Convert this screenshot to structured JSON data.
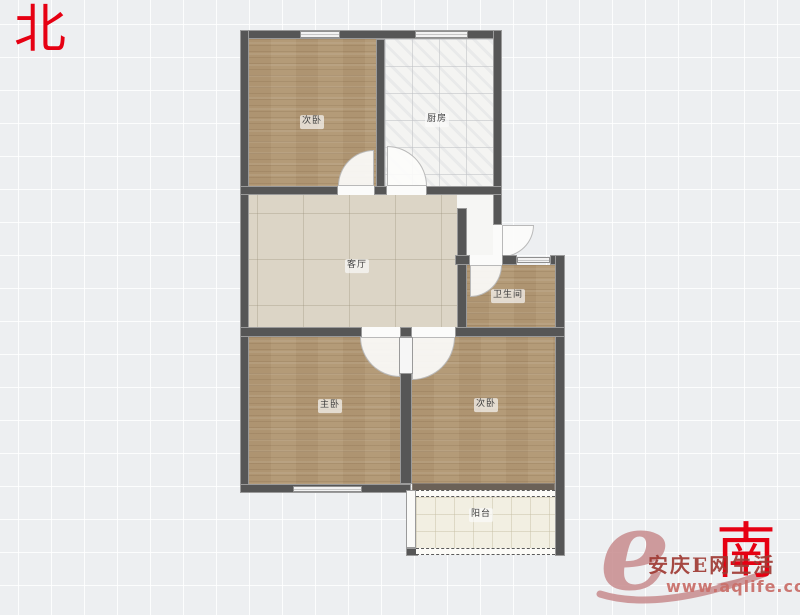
{
  "compass": {
    "north_label": "北",
    "south_label": "南",
    "color": "#e60012"
  },
  "floorplan": {
    "wall_color": "#5b5b5b",
    "rooms": [
      {
        "id": "bedroom-top-left",
        "label": "次卧",
        "floor": "wood"
      },
      {
        "id": "kitchen",
        "label": "厨房",
        "floor": "white-marble-tile"
      },
      {
        "id": "living-room",
        "label": "客厅",
        "floor": "beige-tile"
      },
      {
        "id": "bathroom",
        "label": "卫生间",
        "floor": "wood"
      },
      {
        "id": "master-bedroom",
        "label": "主卧",
        "floor": "wood"
      },
      {
        "id": "bedroom-bottom-right",
        "label": "次卧",
        "floor": "wood"
      },
      {
        "id": "balcony",
        "label": "阳台",
        "floor": "cream-tile"
      }
    ]
  },
  "watermark": {
    "logo_letter": "e",
    "site_name": "安庆E网生活",
    "site_url": "www.aqlife.com",
    "brand_red": "#9e3a33",
    "logo_pink": "#c98b8d"
  }
}
